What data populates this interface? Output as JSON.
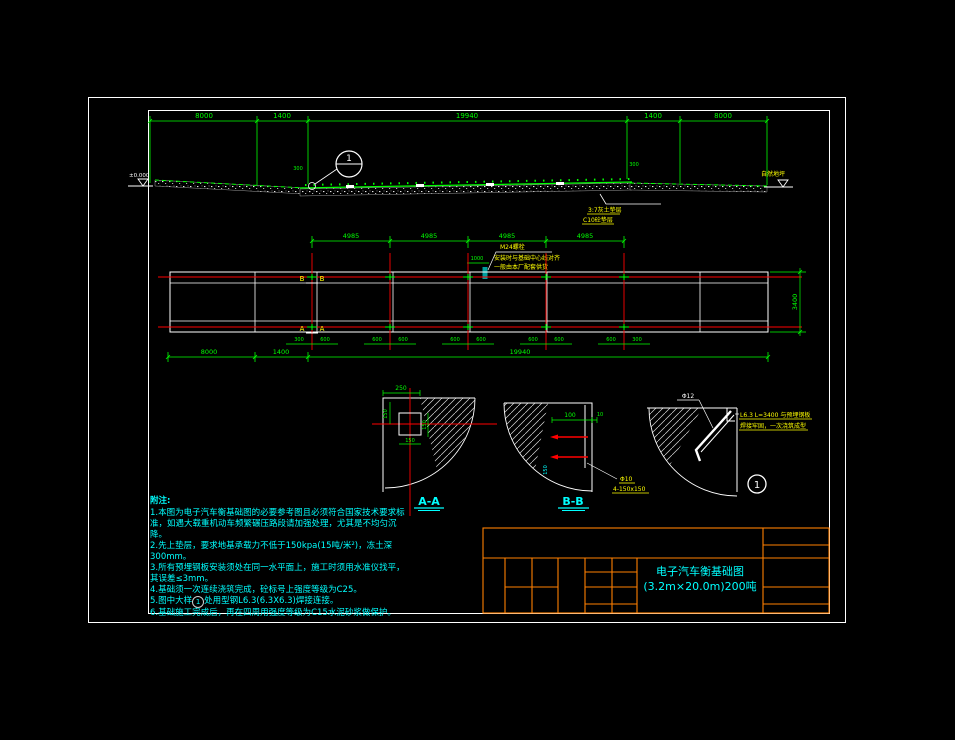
{
  "colors": {
    "background": "#000000",
    "frame": "#ffffff",
    "dimension": "#00ff00",
    "centerline": "#ff0000",
    "annotation": "#ffff00",
    "notes": "#00ffff",
    "title_block": "#ff7f00"
  },
  "overview": {
    "dims": [
      "8000",
      "1400",
      "19940",
      "1400",
      "8000"
    ],
    "dim_left_300": "300",
    "dim_right_300": "300",
    "elev_left": "±0.000",
    "ground_right": "自然地坪",
    "callout": "1",
    "layer1": "3:7灰土垫层",
    "layer2": "C10砼垫层"
  },
  "plan": {
    "dims_top": [
      "4985",
      "4985",
      "4985",
      "4985"
    ],
    "dim_1000": "1000",
    "bolt_note1": "M24螺栓",
    "bolt_note2": "安装时与基础中心线对齐",
    "bolt_note3": "一般由本厂配套供货",
    "marker_b": "B",
    "marker_a": "A",
    "pair_dims": [
      [
        "300",
        "600"
      ],
      [
        "600",
        "600"
      ],
      [
        "600",
        "600"
      ],
      [
        "600",
        "600"
      ],
      [
        "600",
        "300"
      ]
    ],
    "dims_bottom": [
      "8000",
      "1400",
      "19940"
    ],
    "dim_height": "3400"
  },
  "sections": {
    "aa": {
      "label": "A-A",
      "top": "250",
      "left": "150",
      "right": "150",
      "bottom": "150"
    },
    "bb": {
      "label": "B-B",
      "top": "100",
      "small": "10",
      "side": "150",
      "leader1": "Φ10",
      "leader2": "4-150x150"
    },
    "d1": {
      "num": "1",
      "bar": "Φ12",
      "note1": "L6.3 L=3400 与预埋钢板",
      "note2": "焊接牢固，一次浇筑成型"
    }
  },
  "notes": {
    "title": "附注:",
    "n1": "1.本图为电子汽车衡基础图的必要参考图且必须符合国家技术要求标准，如遇大载重机动车频繁碾压路段请加强处理，尤其是不均匀沉降。",
    "n2": "2.先上垫层，要求地基承载力不低于150kpa(15吨/米²)，冻土深300mm。",
    "n3": "3.所有预埋钢板安装须处在同一水平面上，施工时须用水准仪找平，其误差≤3mm。",
    "n4": "4.基础须一次连续浇筑完成，砼标号上强度等级为C25。",
    "n5a": "5.图中大样",
    "n5b": "1",
    "n5c": "处用型钢L6.3(6.3X6.3)焊接连接。",
    "n6": "6.基础施工完成后，再在四周用强度等级为C15水泥砂浆做保护。"
  },
  "title_block": {
    "line1": "电子汽车衡基础图",
    "line2": "(3.2m×20.0m)200吨"
  }
}
